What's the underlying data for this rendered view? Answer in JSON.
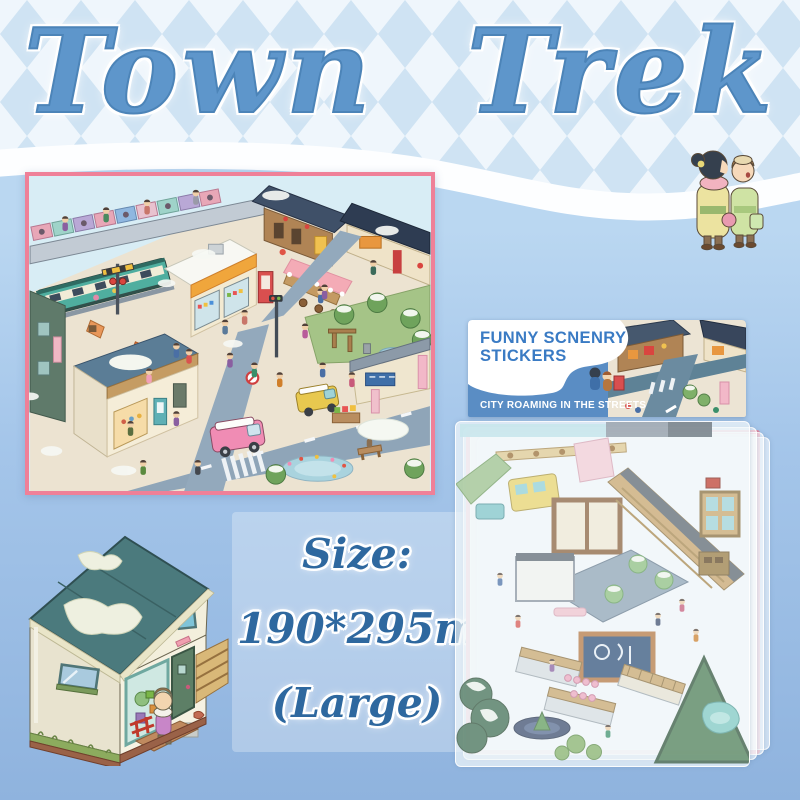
{
  "title": {
    "text": "Town Trek"
  },
  "package": {
    "title_line1": "FUNNY SCNENRY",
    "title_line2": "STICKERS",
    "subtitle": "CITY ROAMING IN THE STREETS",
    "bg_color": "#5a8dc4",
    "title_color": "#3a7bc4",
    "subtitle_color": "#ffffff"
  },
  "size_info": {
    "label": "Size:",
    "dimensions": "190*295mm",
    "variant": "(Large)",
    "text_color": "#2e689f"
  },
  "decor": {
    "hero_characters_icon": "two-kimono-characters",
    "main_illustration": "isometric-town-scene",
    "house_illustration": "isometric-house",
    "sticker_sheets": "translucent-sticker-sheet-stack",
    "hang_hole_icon": "white-circle-hang-hole"
  },
  "theme": {
    "title_blue": "#5e96cb",
    "diamond": "#cfe3f3",
    "diamond_bg": "#eff6fc",
    "body_top": "#bad7f1",
    "body_bottom": "#8fb3de",
    "border_pink": "#ef8098",
    "package_bg": "#5a8dc4",
    "package_title": "#3a7bc4",
    "size_text": "#2e689f",
    "wave_white": "#fdfeff"
  }
}
